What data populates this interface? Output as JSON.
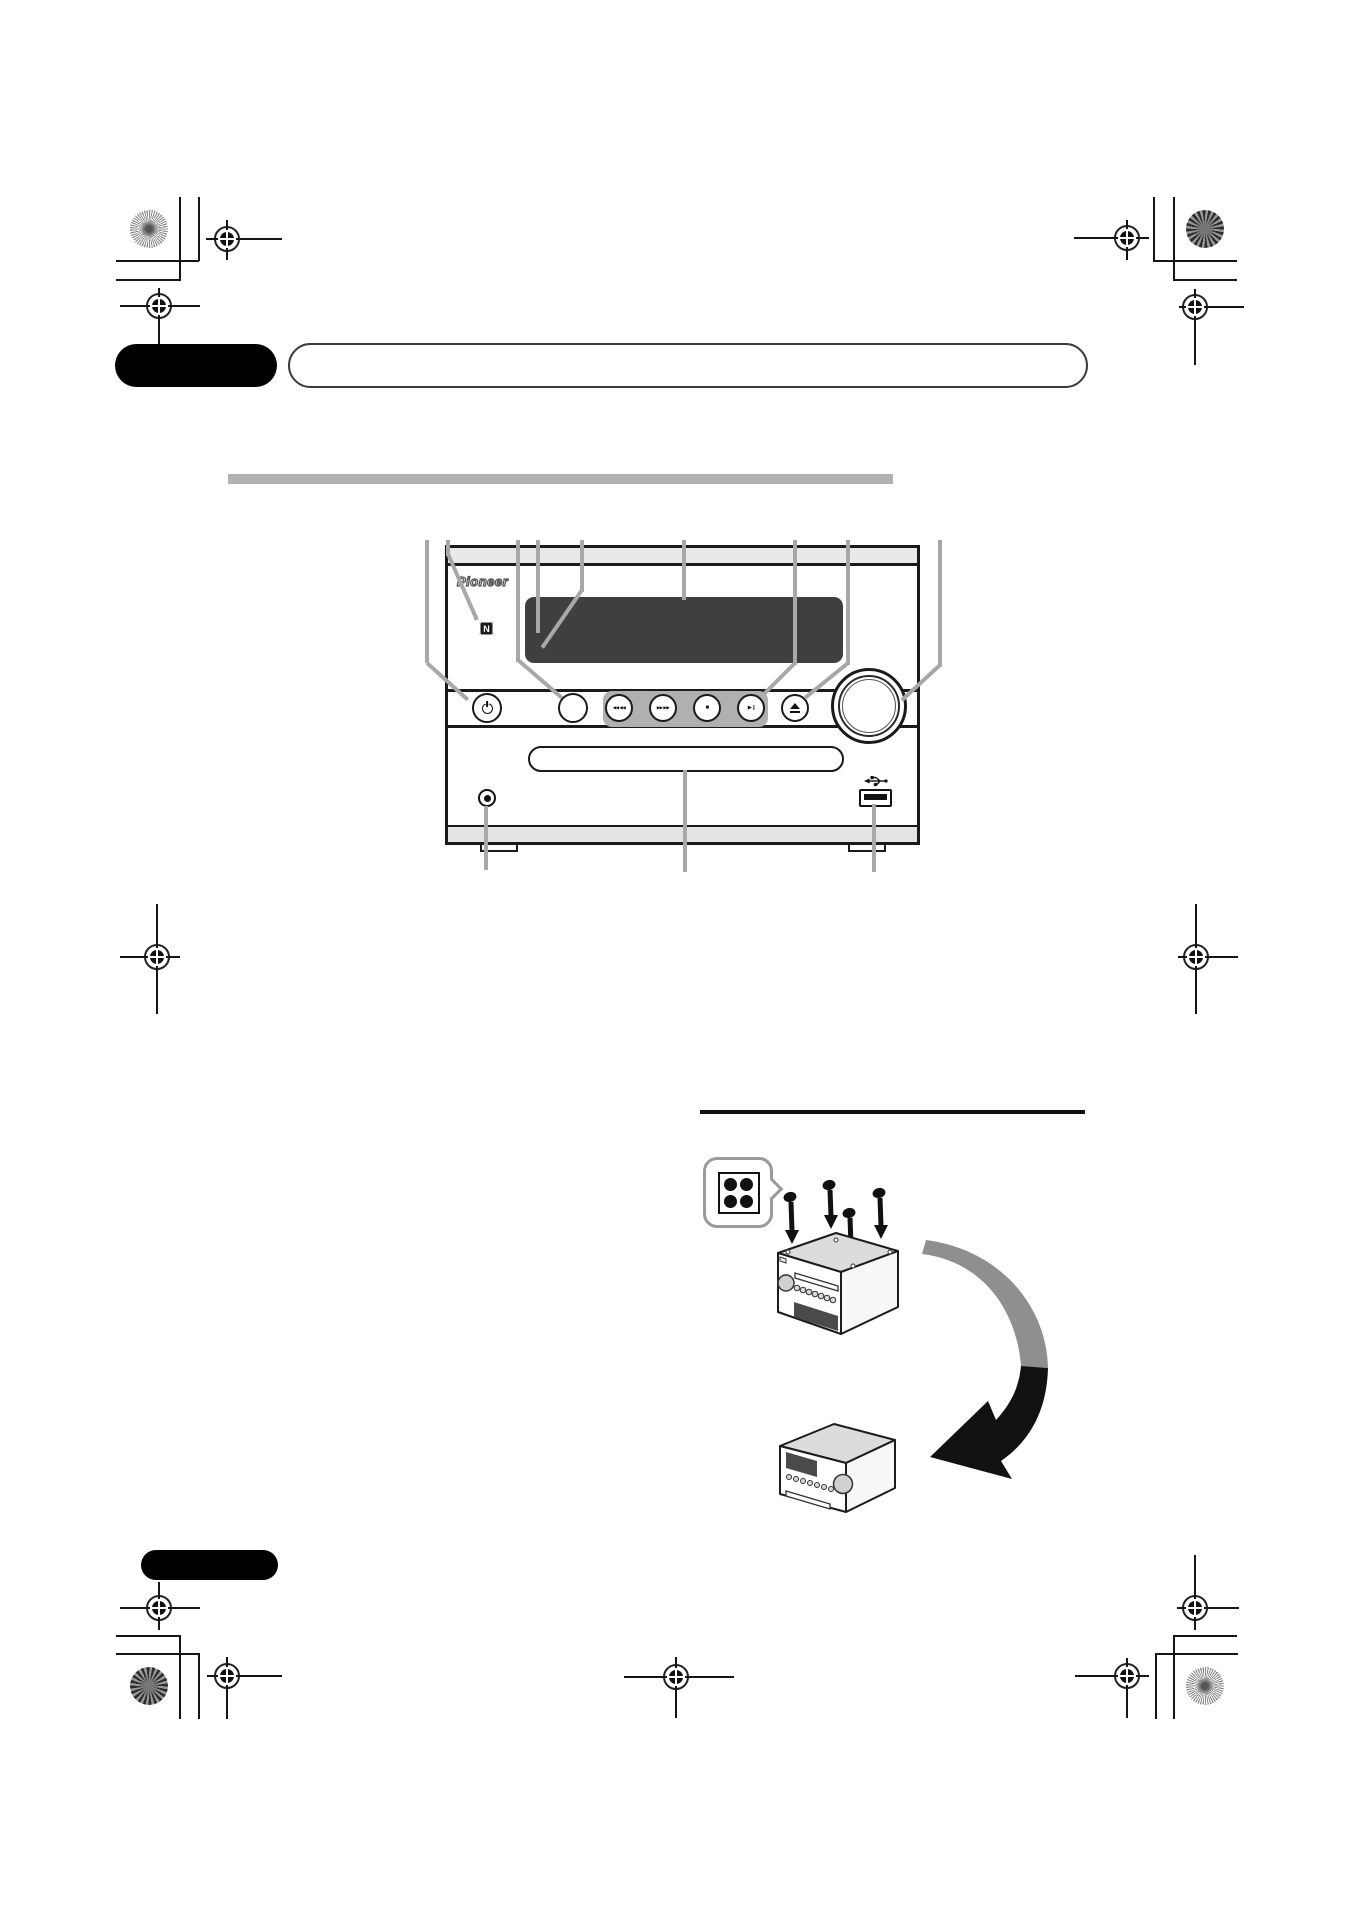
{
  "page": {
    "width": 1354,
    "height": 1916,
    "background": "#ffffff"
  },
  "header": {
    "black_tab_text": "",
    "banner_text": ""
  },
  "section_divider": {
    "color": "#b2b2b2"
  },
  "front_panel_figure": {
    "brand_logo": "Pioneer",
    "nfc_badge": "N",
    "display_text": "",
    "transport": {
      "prev": "◀◀ ◀◀",
      "next": "▶▶ ▶▶",
      "stop": "■",
      "play_pause": "▶ ||",
      "eject": "▲"
    },
    "icons": {
      "power": "power-symbol",
      "source": "blank-round-button",
      "volume": "rotary-knob",
      "usb": "usb-symbol",
      "headphones": "mini-jack",
      "nfc": "n-mark",
      "disc_slot": "cd-loading-slot",
      "display": "blank-display-window"
    },
    "callout_color": "#a8a8a8"
  },
  "install_figure": {
    "screw_badge_dots": 4,
    "screw_count": 4,
    "arrow": {
      "start_color": "#8f8f8f",
      "end_color": "#111111",
      "curve": "right-then-down-to-left"
    }
  },
  "printer_marks": {
    "registration_marks": 9,
    "corner_targets": [
      "sunburst",
      "checker",
      "checker",
      "sunburst"
    ]
  }
}
